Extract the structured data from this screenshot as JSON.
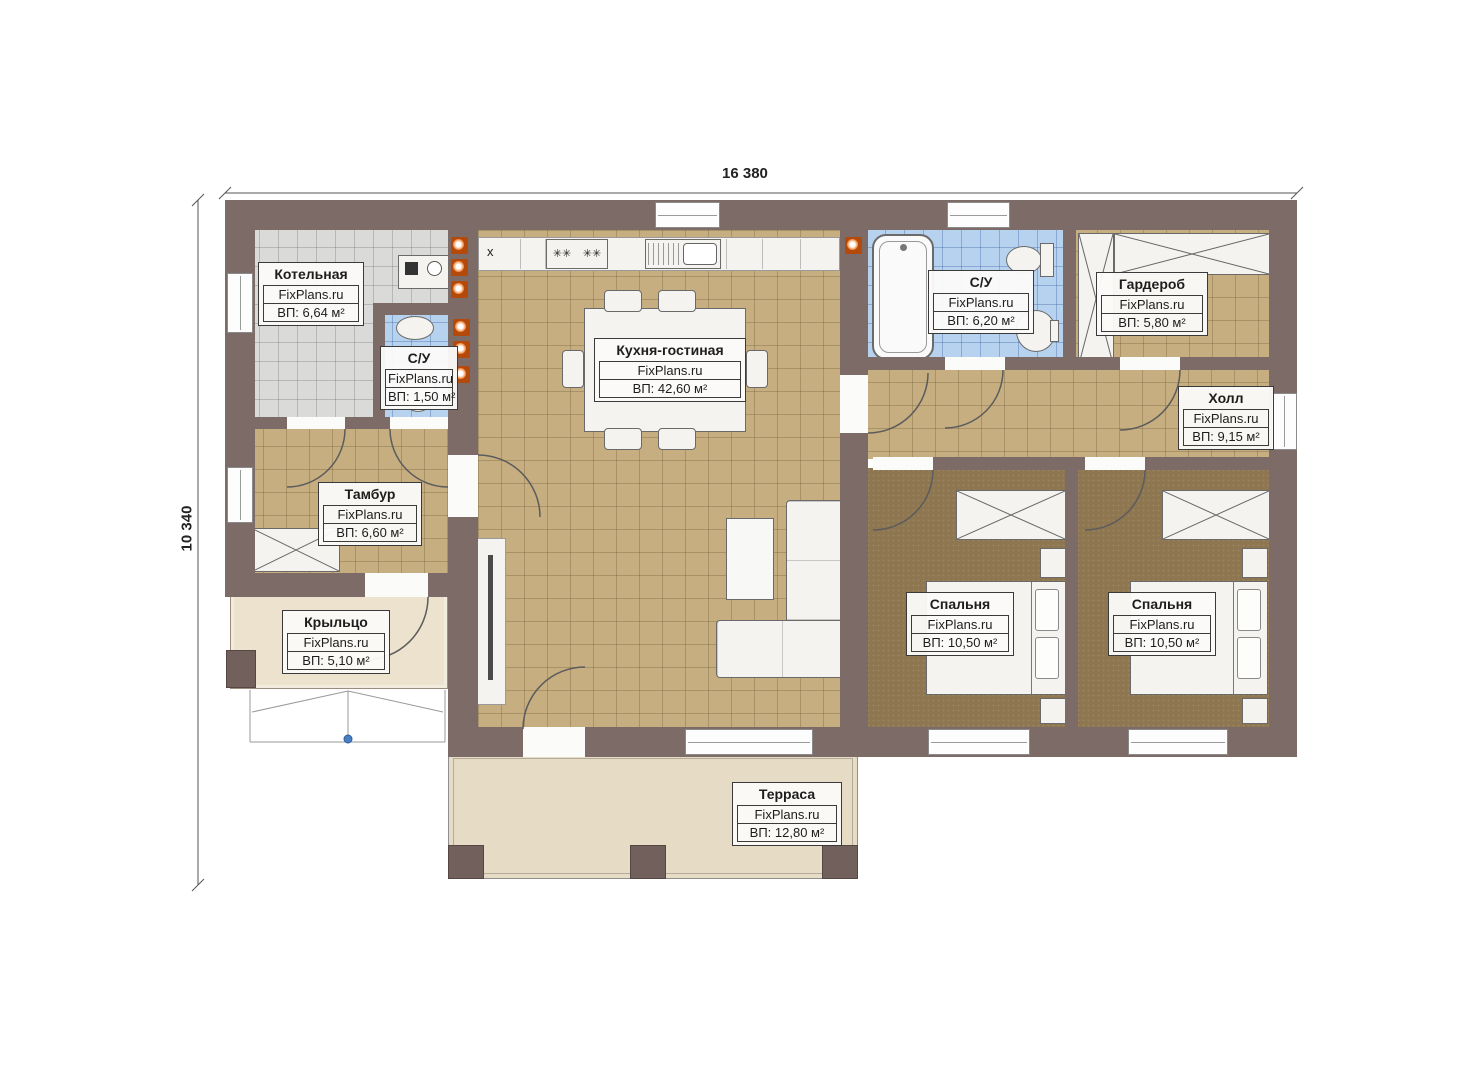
{
  "site": "FixPlans.ru",
  "dimensions": {
    "top": "16 380",
    "left": "10 340"
  },
  "counter_mark": "x",
  "rooms": [
    {
      "name": "Котельная",
      "area": "ВП: 6,64 м²"
    },
    {
      "name": "С/У",
      "area": "ВП: 1,50 м²"
    },
    {
      "name": "Кухня-гостиная",
      "area": "ВП: 42,60 м²"
    },
    {
      "name": "С/У",
      "area": "ВП: 6,20 м²"
    },
    {
      "name": "Гардероб",
      "area": "ВП: 5,80 м²"
    },
    {
      "name": "Холл",
      "area": "ВП: 9,15 м²"
    },
    {
      "name": "Тамбур",
      "area": "ВП: 6,60 м²"
    },
    {
      "name": "Крыльцо",
      "area": "ВП: 5,10 м²"
    },
    {
      "name": "Спальня",
      "area": "ВП: 10,50 м²"
    },
    {
      "name": "Спальня",
      "area": "ВП: 10,50 м²"
    },
    {
      "name": "Терраса",
      "area": "ВП: 12,80 м²"
    }
  ],
  "colors": {
    "wall": "#7d6b67",
    "floor_tan": "#c6ae80",
    "floor_bedroom": "#8d7650",
    "floor_bath": "#b7d2ef",
    "floor_boiler": "#dadad8",
    "floor_terrace": "#e6dbc5",
    "floor_porch": "#ece2cd",
    "radiator_orange": "#e06a10",
    "marker_blue": "#4a7ec2"
  }
}
